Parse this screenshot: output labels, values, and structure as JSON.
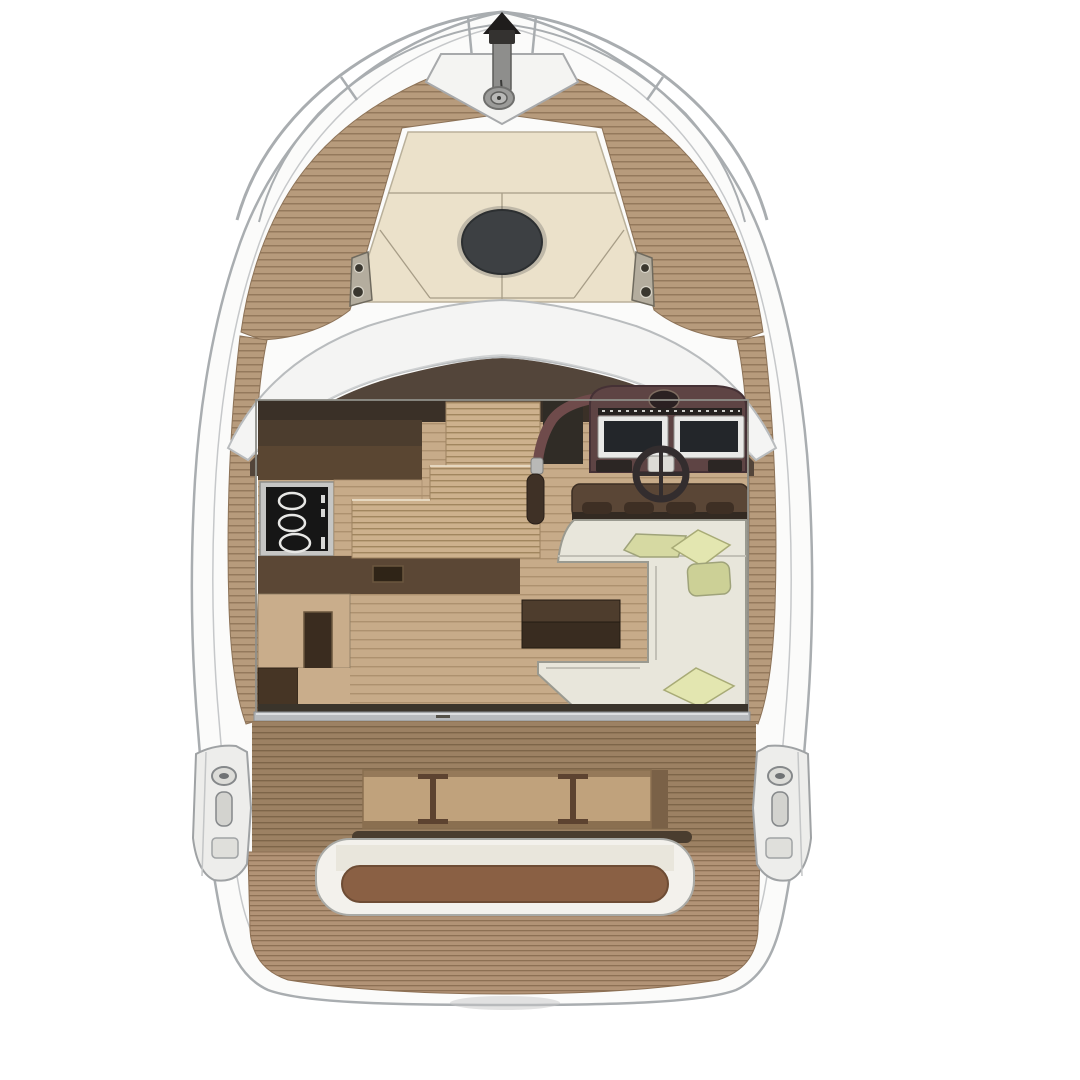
{
  "meta": {
    "type": "yacht-deck-plan-top-view",
    "description": "Top-down architectural floor plan rendering of a motor yacht"
  },
  "boat": {
    "bow": {
      "fixtures": [
        "pulpit-rails",
        "anchor-roller",
        "windlass",
        "anchor-locker"
      ]
    },
    "foredeck": {
      "fixtures": [
        "sunpad",
        "bow-hatch",
        "cleat-left",
        "cleat-right",
        "teak-deck"
      ]
    },
    "helm_deck": {
      "fixtures": [
        "windshield",
        "dashboard"
      ]
    },
    "cabin": {
      "fixtures": [
        "galley-cabinet",
        "cooktop",
        "galley-counter",
        "sink",
        "companionway-stairs",
        "grab-rail",
        "helm-console",
        "instrument-screens",
        "compass",
        "steering-wheel",
        "helm-bench",
        "sofa",
        "pillows",
        "coffee-table",
        "door-track"
      ]
    },
    "cockpit": {
      "fixtures": [
        "teak-sole",
        "folding-table",
        "transom-seat",
        "mooring-pod-left",
        "mooring-pod-right"
      ]
    },
    "stern": {
      "fixtures": [
        "swim-platform"
      ]
    }
  },
  "colors": {
    "background": "#ffffff",
    "hull_white": "#fbfbfa",
    "hull_outline": "#a9adb0",
    "deck_edge_line": "#c6c8ca",
    "rail_gray": "#a9adb0",
    "wood_deck": "#b79b7c",
    "wood_deck_line": "#94795c",
    "wood_cockpit": "#9c8163",
    "wood_cockpit_line": "#7d6549",
    "wood_aft": "#b29376",
    "wood_aft_line": "#8d7054",
    "wood_floor": "#c7ab89",
    "wood_floor_line": "#ad916f",
    "wood_stairs": "#cdb18d",
    "wood_stairs_line": "#a1865f",
    "sunpad_cream": "#ebe1ca",
    "sunpad_seam": "#a79d87",
    "hatch_dark": "#3d4043",
    "locker_white": "#f4f4f2",
    "anchor_dark": "#1f1d1c",
    "metal_gray": "#9b9b99",
    "windshield_white": "#f4f4f3",
    "dashboard_brown": "#53453a",
    "cabin_top_dark": "#3a3027",
    "cabinet_dark": "#4c3d2e",
    "cabinet_mid": "#5a4632",
    "counter_brown": "#5b4735",
    "counter_light": "#c9ad8b",
    "sink_dark": "#3a2c1f",
    "cooktop_frame": "#c6c6c4",
    "cooktop_black": "#161616",
    "burner_white": "#e8e8e6",
    "helm_maroon": "#5e4444",
    "helm_rail_maroon": "#6f4b4b",
    "screen_frame": "#e9e9e7",
    "screen_dark": "#23262a",
    "compass_dark": "#2b2122",
    "wheel_dark": "#332d2e",
    "wheel_hub": "#dddbd6",
    "bench_brown": "#5a4636",
    "bench_divot": "#3e2f24",
    "sofa_cream": "#e8e6db",
    "sofa_outline": "#9a9a90",
    "pillow_light": "#e3e6b0",
    "pillow_mid": "#d6d9a2",
    "pillow_dark": "#ccd096",
    "table_dark_top": "#4e3d2d",
    "table_dark_bottom": "#392c20",
    "threshold_dark": "#3a342b",
    "threshold_silver": "#b7babd",
    "cockpit_table_top": "#c0a27c",
    "cockpit_table_edge": "#8a6f50",
    "cockpit_table_brace": "#5d4330",
    "seat_rim_dark": "#4a3d2f",
    "seat_white": "#f3f1ec",
    "seat_inner_cream": "#e9e6dc",
    "seat_cushion": "#8a6044",
    "pod_white": "#ededeb",
    "cleat_metal": "#b4ad9e",
    "shadow_gray": "#c7c7c7"
  }
}
